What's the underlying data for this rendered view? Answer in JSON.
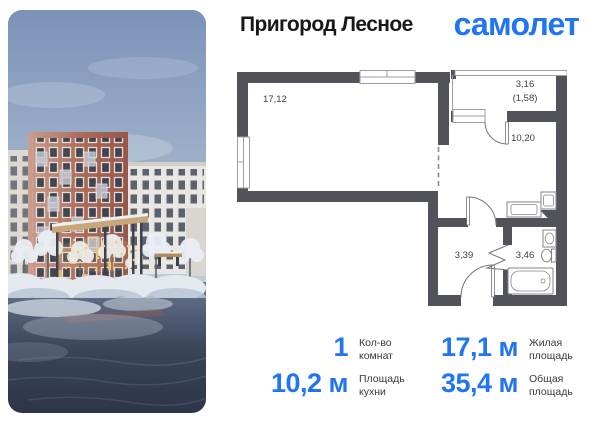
{
  "header": {
    "project_name": "Пригород Лесное",
    "brand_logo_text": "самолет"
  },
  "floorplan": {
    "living_room_area": "17,12",
    "balcony_area": "3,16",
    "balcony_area_reduced": "(1,58)",
    "kitchen_area": "10,20",
    "hallway_area": "3,39",
    "bathroom_area": "3,46"
  },
  "stats": {
    "rooms": {
      "value": "1",
      "label_line1": "Кол-во",
      "label_line2": "комнат"
    },
    "living": {
      "value": "17,1 м",
      "label_line1": "Жилая",
      "label_line2": "площадь"
    },
    "kitchen": {
      "value": "10,2 м",
      "label_line1": "Площадь",
      "label_line2": "кухни"
    },
    "total": {
      "value": "35,4 м",
      "label_line1": "Общая",
      "label_line2": "площадь"
    }
  },
  "colors": {
    "accent": "#2175f2",
    "wall": "#52525b"
  }
}
